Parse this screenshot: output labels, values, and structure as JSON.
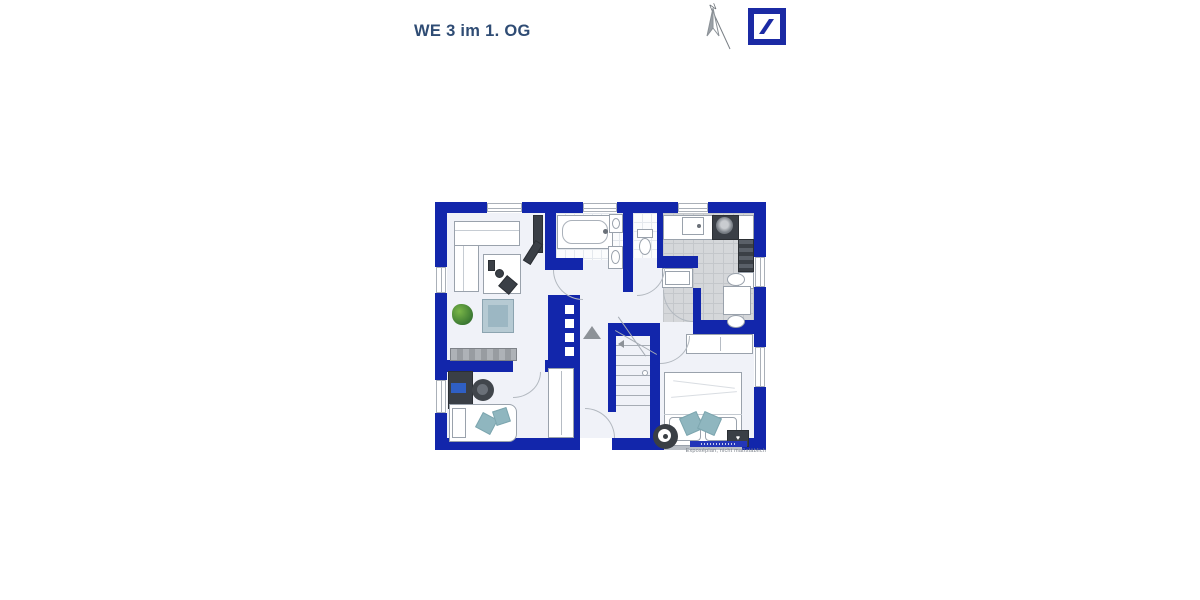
{
  "header": {
    "title": "WE 3 im 1. OG",
    "north_label": "N"
  },
  "plan": {
    "caption": "Exposéplan, nicht maßstäblich"
  },
  "icons": {
    "heart": "♥"
  },
  "colors": {
    "wall_blue": "#1226ab",
    "logo_blue": "#1b2aa4",
    "title_color": "#2f4c74",
    "teal_accent": "#8fb6bf",
    "kitchen_tile_gray": "#d5d7da",
    "caption_gray": "#7d838b"
  }
}
